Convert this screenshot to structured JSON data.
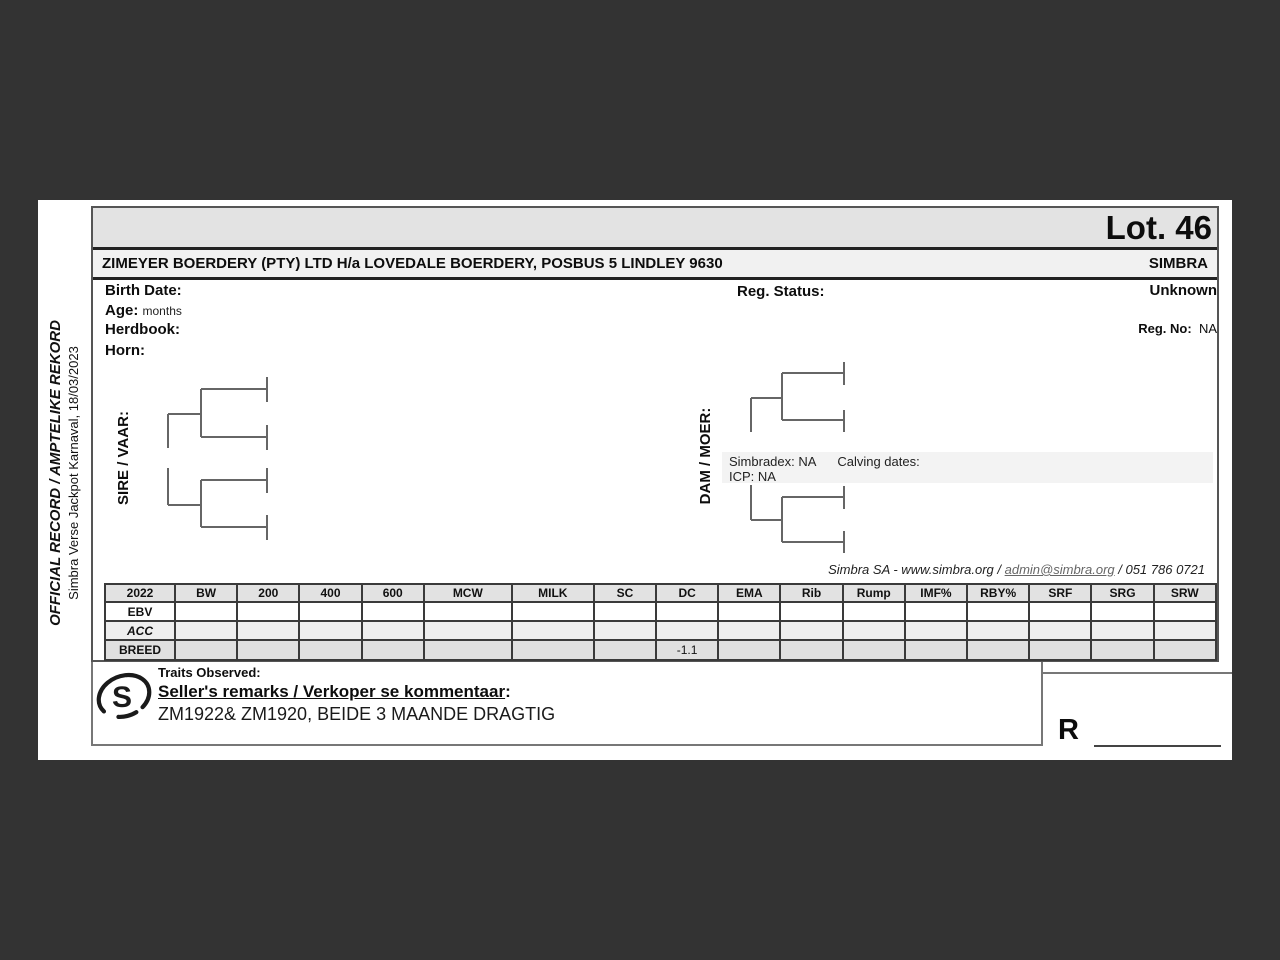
{
  "colors": {
    "page_background": "#333333",
    "sheet_background": "#ffffff",
    "band_background": "#e3e3e3",
    "owner_row_background": "#f1f1f1",
    "acc_row_background": "#eeeeee",
    "breed_row_background": "#e0e0e0",
    "simbradex_band_background": "#f3f3f3"
  },
  "sidebar": {
    "title": "OFFICIAL RECORD / AMPTELIKE REKORD",
    "subtitle": "Simbra Verse Jackpot Karnaval, 18/03/2023"
  },
  "header": {
    "lot": "Lot. 46",
    "owner": "ZIMEYER BOERDERY (PTY) LTD H/a LOVEDALE BOERDERY, POSBUS 5 LINDLEY 9630",
    "breed": "SIMBRA"
  },
  "info": {
    "birth_date_label": "Birth Date:",
    "age_label": "Age:",
    "age_value": "months",
    "herdbook_label": "Herdbook:",
    "horn_label": "Horn:",
    "reg_status_label": "Reg. Status:",
    "reg_status_value": "Unknown",
    "reg_no_label": "Reg. No:",
    "reg_no_value": "NA"
  },
  "pedigree": {
    "sire_label": "SIRE / VAAR:",
    "dam_label": "DAM / MOER:",
    "simbradex": "Simbradex: NA",
    "calving": "Calving dates:",
    "icp": "ICP: NA"
  },
  "contact": {
    "prefix": "Simbra SA - www.simbra.org / ",
    "link": "admin@simbra.org",
    "suffix": " / 051 786 0721"
  },
  "table": {
    "columns": [
      "2022",
      "BW",
      "200",
      "400",
      "600",
      "MCW",
      "MILK",
      "SC",
      "DC",
      "EMA",
      "Rib",
      "Rump",
      "IMF%",
      "RBY%",
      "SRF",
      "SRG",
      "SRW"
    ],
    "rows": [
      {
        "label": "EBV",
        "values": [
          "",
          "",
          "",
          "",
          "",
          "",
          "",
          "",
          "",
          "",
          "",
          "",
          "",
          "",
          "",
          ""
        ]
      },
      {
        "label": "ACC",
        "values": [
          "",
          "",
          "",
          "",
          "",
          "",
          "",
          "",
          "",
          "",
          "",
          "",
          "",
          "",
          "",
          ""
        ]
      },
      {
        "label": "BREED",
        "values": [
          "",
          "",
          "",
          "",
          "",
          "",
          "",
          "-1.1",
          "",
          "",
          "",
          "",
          "",
          "",
          "",
          ""
        ]
      }
    ]
  },
  "remarks": {
    "traits_label": "Traits Observed:",
    "seller_label": "Seller's remarks / Verkoper se kommentaar",
    "seller_colon": ":",
    "text": "ZM1922& ZM1920, BEIDE 3 MAANDE DRAGTIG",
    "logo_letter": "S"
  },
  "price": {
    "currency_symbol": "R"
  }
}
